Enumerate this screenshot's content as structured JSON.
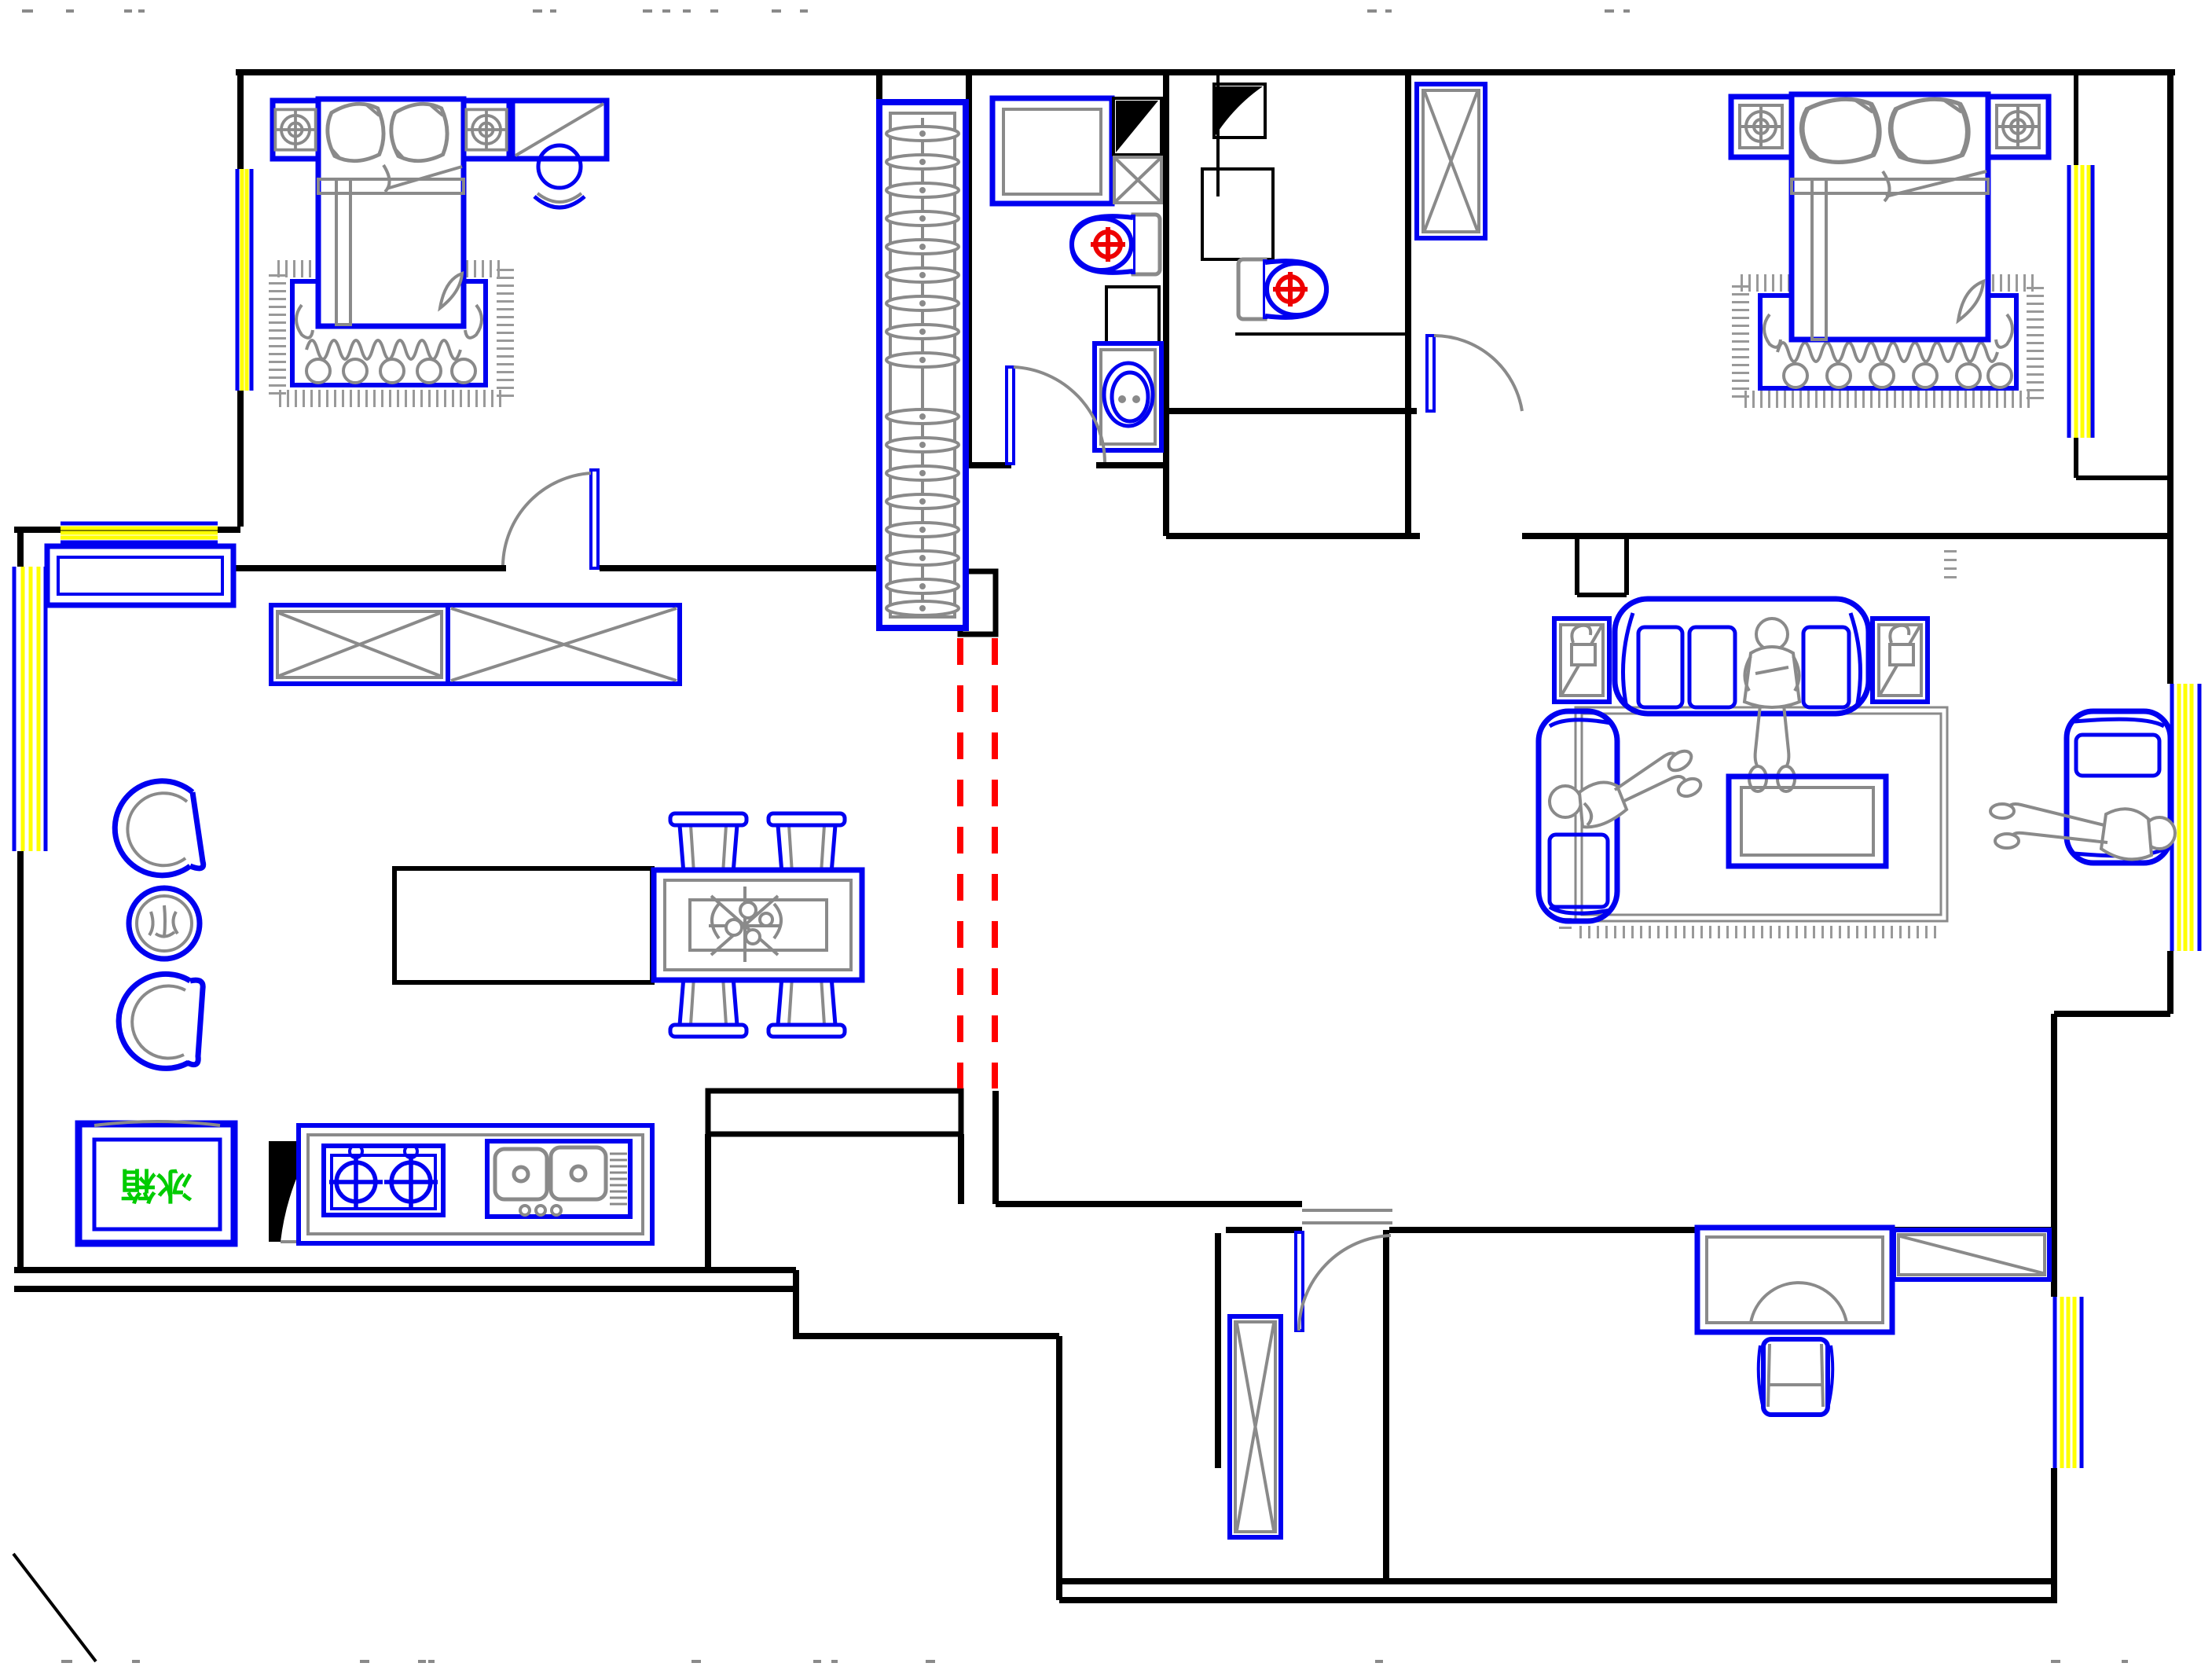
{
  "drawing": {
    "type": "residential-floor-plan",
    "labels": {
      "refrigerator": "冰箱"
    },
    "colors": {
      "background": "#ffffff",
      "wall": "#000000",
      "furniture_outline": "#0000f0",
      "detail_gray": "#8a8a8a",
      "window_glass": "#ffff00",
      "demolition_dashed": "#ff0000",
      "appliance_label_green": "#00cc00"
    },
    "symbols": {
      "lamp-target-icon": "square with concentric circles and cross (bedside lamp)",
      "burner-icon": "circle with crosshair (gas burner)",
      "toilet-icon": "oval bowl with tank and red valve crosshair",
      "hanger-icon": "flat ellipse on closet rail",
      "x-cabinet-icon": "rectangle with diagonal cross (wardrobe/cabinet)",
      "window-icon": "triple yellow lines between blue frames",
      "door-icon": "leaf with quarter-circle swing arc",
      "demolition-icon": "paired red dashed lines (removed wall opening)"
    },
    "rooms": [
      {
        "id": "bedroom-master",
        "items": [
          "double-bed",
          "pillows",
          "nightstand-lamp-left",
          "nightstand-lamp-right",
          "wardrobe-cabinet",
          "vanity-mirror",
          "area-rug",
          "door"
        ]
      },
      {
        "id": "hall-closet",
        "items": [
          "hanger-rail",
          "hangers"
        ]
      },
      {
        "id": "bathroom-1",
        "items": [
          "shower-grid",
          "vent-duct",
          "exhaust-box",
          "toilet",
          "washer-box",
          "wash-basin",
          "door"
        ]
      },
      {
        "id": "bathroom-2",
        "items": [
          "vent-duct",
          "storage-box",
          "toilet",
          "shower-partition"
        ]
      },
      {
        "id": "bedroom-2",
        "items": [
          "double-bed",
          "pillows",
          "nightstand-lamp-left",
          "nightstand-lamp-right",
          "tall-wardrobe",
          "area-rug",
          "door",
          "balcony-strip"
        ]
      },
      {
        "id": "living-room",
        "items": [
          "sofa-main",
          "sofa-left",
          "armchair-right",
          "coffee-table",
          "end-table-lamp-left",
          "end-table-lamp-right",
          "area-rug",
          "person-sitting",
          "person-lounging",
          "person-lying"
        ]
      },
      {
        "id": "dining-room",
        "items": [
          "dining-table",
          "dining-chairs-4",
          "flower-centerpiece",
          "bar-counter",
          "sideboard",
          "tub-chair-upper",
          "tub-chair-lower",
          "round-plant-table",
          "x-cabinet-left",
          "x-cabinet-right"
        ]
      },
      {
        "id": "kitchen",
        "items": [
          "refrigerator",
          "duct-wedge",
          "gas-stove-2-burner",
          "double-sink-drainer",
          "counter"
        ]
      },
      {
        "id": "entry-foyer",
        "items": [
          "entry-door",
          "shoe-cabinet",
          "threshold"
        ]
      },
      {
        "id": "study",
        "items": [
          "desk-arched",
          "office-chair",
          "bookshelf-diagonal"
        ]
      }
    ],
    "windows_count": 6,
    "demolition_note": "pair of red dashed vertical lines in passage between dining and living zones"
  }
}
